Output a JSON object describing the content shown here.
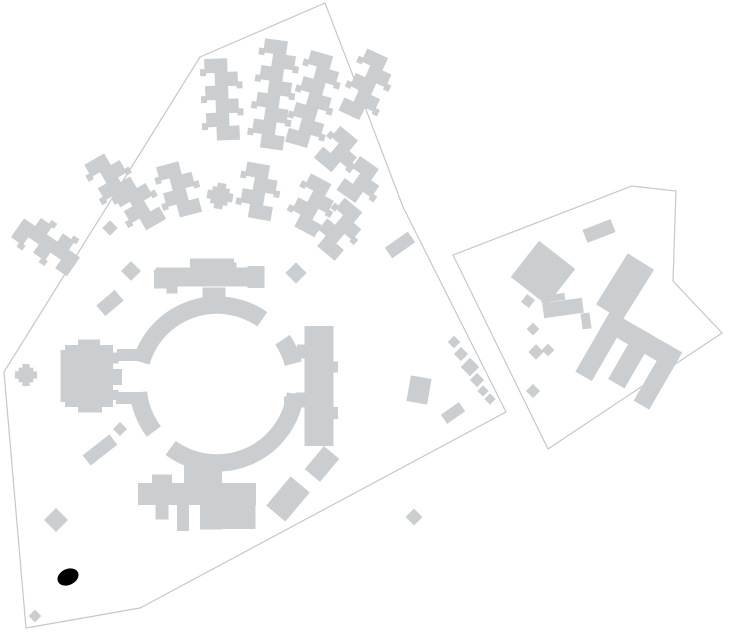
{
  "canvas": {
    "width": 734,
    "height": 639,
    "background": "#ffffff"
  },
  "palette": {
    "building_fill": "#cbced1",
    "boundary_stroke": "#c7c7c7",
    "marker_fill": "#000000"
  },
  "parcels": [
    {
      "name": "parcel-west-campus",
      "points": [
        [
          4,
          372
        ],
        [
          200,
          57
        ],
        [
          325,
          3
        ],
        [
          370,
          120
        ],
        [
          403,
          207
        ],
        [
          506,
          412
        ],
        [
          155,
          600
        ],
        [
          140,
          608
        ],
        [
          26,
          628
        ]
      ]
    },
    {
      "name": "parcel-east-campus",
      "points": [
        [
          453,
          255
        ],
        [
          632,
          186
        ],
        [
          676,
          191
        ],
        [
          673,
          281
        ],
        [
          722,
          333
        ],
        [
          548,
          449
        ]
      ]
    }
  ],
  "ring_building": {
    "name": "circular-ring-building",
    "cx": 217,
    "cy": 384,
    "radius_mid": 79,
    "band_width": 17.5,
    "segments_deg": [
      [
        7,
        126
      ],
      [
        143,
        174
      ],
      [
        196,
        305
      ],
      [
        326,
        345
      ]
    ]
  },
  "zigzag_blocks": {
    "brick_w": 23,
    "brick_h": 13.5,
    "offset": 5,
    "items": [
      {
        "name": "zigzag-far-west",
        "cx": 48,
        "cy": 243,
        "rot": -55,
        "bricks": 5
      },
      {
        "name": "zigzag-west-1",
        "cx": 112,
        "cy": 180,
        "rot": -30,
        "bricks": 4
      },
      {
        "name": "zigzag-west-2",
        "cx": 138,
        "cy": 203,
        "rot": -30,
        "bricks": 4
      },
      {
        "name": "zigzag-north-1",
        "cx": 222,
        "cy": 99,
        "rot": -2,
        "bricks": 6
      },
      {
        "name": "zigzag-north-2",
        "cx": 274,
        "cy": 94,
        "rot": 8,
        "bricks": 8
      },
      {
        "name": "zigzag-north-3",
        "cx": 314,
        "cy": 100,
        "rot": 16,
        "bricks": 7
      },
      {
        "name": "zigzag-northeast-1",
        "cx": 340,
        "cy": 152,
        "rot": 40,
        "bricks": 3
      },
      {
        "name": "zigzag-northeast-2",
        "cx": 368,
        "cy": 86,
        "rot": 25,
        "bricks": 5
      },
      {
        "name": "zigzag-east-1",
        "cx": 362,
        "cy": 182,
        "rot": 35,
        "bricks": 3
      },
      {
        "name": "zigzag-east-2",
        "cx": 340,
        "cy": 229,
        "rot": 40,
        "bricks": 4
      },
      {
        "name": "zigzag-inner-west",
        "cx": 179,
        "cy": 189,
        "rot": -15,
        "bricks": 4
      },
      {
        "name": "zigzag-inner-mid",
        "cx": 259,
        "cy": 191,
        "rot": 10,
        "bricks": 4
      },
      {
        "name": "zigzag-inner-east",
        "cx": 313,
        "cy": 205,
        "rot": 28,
        "bricks": 4
      }
    ]
  },
  "rect_blocks": [
    {
      "name": "west-hall-main",
      "cx": 89,
      "cy": 376,
      "w": 48,
      "h": 62,
      "rot": 0
    },
    {
      "name": "west-hall-wing",
      "cx": 64,
      "cy": 376,
      "w": 7,
      "h": 52,
      "rot": 0
    },
    {
      "name": "west-hall-tab-top",
      "cx": 89,
      "cy": 344,
      "w": 22,
      "h": 9,
      "rot": 0
    },
    {
      "name": "west-hall-tab-bottom",
      "cx": 90,
      "cy": 408,
      "w": 24,
      "h": 9,
      "rot": 0
    },
    {
      "name": "west-hall-bump-1",
      "cx": 114,
      "cy": 358,
      "w": 9,
      "h": 11,
      "rot": 0
    },
    {
      "name": "west-hall-bump-2",
      "cx": 116,
      "cy": 377,
      "w": 12,
      "h": 16,
      "rot": 0
    },
    {
      "name": "west-hall-bump-3",
      "cx": 114,
      "cy": 395,
      "w": 9,
      "h": 10,
      "rot": 0
    },
    {
      "name": "west-hall-link-top",
      "cx": 130,
      "cy": 355,
      "w": 26,
      "h": 12,
      "rot": 0
    },
    {
      "name": "west-hall-link-bottom",
      "cx": 128,
      "cy": 398,
      "w": 24,
      "h": 12,
      "rot": 0
    },
    {
      "name": "north-bar-main",
      "cx": 210,
      "cy": 277,
      "w": 108,
      "h": 19,
      "rot": 0
    },
    {
      "name": "north-bar-center",
      "cx": 212,
      "cy": 264,
      "w": 44,
      "h": 11,
      "rot": 0
    },
    {
      "name": "north-bar-cap-west",
      "cx": 162,
      "cy": 279,
      "w": 16,
      "h": 19,
      "rot": 0
    },
    {
      "name": "north-bar-cap-east",
      "cx": 256,
      "cy": 277,
      "w": 17,
      "h": 22,
      "rot": 0
    },
    {
      "name": "north-bar-tab-east",
      "cx": 231,
      "cy": 266,
      "w": 11,
      "h": 7,
      "rot": 0
    },
    {
      "name": "north-bar-nub-west",
      "cx": 172,
      "cy": 290,
      "w": 11,
      "h": 7,
      "rot": 0
    },
    {
      "name": "north-bar-stub",
      "cx": 214,
      "cy": 294,
      "w": 23,
      "h": 13,
      "rot": 0
    },
    {
      "name": "north-bar-stub-2",
      "cx": 215,
      "cy": 302,
      "w": 13,
      "h": 8,
      "rot": 0
    },
    {
      "name": "east-tower-main",
      "cx": 319,
      "cy": 386,
      "w": 29,
      "h": 120,
      "rot": 0
    },
    {
      "name": "east-tower-bump-1",
      "cx": 301,
      "cy": 351,
      "w": 8,
      "h": 13,
      "rot": 0
    },
    {
      "name": "east-tower-bump-2",
      "cx": 300,
      "cy": 400,
      "w": 9,
      "h": 15,
      "rot": 0
    },
    {
      "name": "east-tower-bump-3",
      "cx": 335,
      "cy": 367,
      "w": 6,
      "h": 11,
      "rot": 0
    },
    {
      "name": "east-tower-bump-4",
      "cx": 335,
      "cy": 413,
      "w": 6,
      "h": 12,
      "rot": 0
    },
    {
      "name": "east-tower-stub-1",
      "cx": 297,
      "cy": 353,
      "w": 20,
      "h": 11,
      "rot": 0
    },
    {
      "name": "east-tower-stub-2",
      "cx": 295,
      "cy": 402,
      "w": 22,
      "h": 11,
      "rot": 0
    },
    {
      "name": "south-wing-connector",
      "cx": 203,
      "cy": 474,
      "w": 38,
      "h": 22,
      "rot": 0
    },
    {
      "name": "south-wing-tab",
      "cx": 162,
      "cy": 479,
      "w": 20,
      "h": 9,
      "rot": 0
    },
    {
      "name": "south-wing-slab",
      "cx": 197,
      "cy": 494,
      "w": 118,
      "h": 22,
      "rot": 0
    },
    {
      "name": "south-wing-prong-1",
      "cx": 162,
      "cy": 512,
      "w": 13,
      "h": 15,
      "rot": 0
    },
    {
      "name": "south-wing-prong-2",
      "cx": 183,
      "cy": 518,
      "w": 12,
      "h": 26,
      "rot": 0
    },
    {
      "name": "south-wing-mid",
      "cx": 211,
      "cy": 517,
      "w": 22,
      "h": 25,
      "rot": 0
    },
    {
      "name": "south-wing-right",
      "cx": 237,
      "cy": 516,
      "w": 37,
      "h": 26,
      "rot": 0
    },
    {
      "name": "southwest-bar",
      "cx": 100,
      "cy": 450,
      "w": 34,
      "h": 13,
      "rot": -38
    },
    {
      "name": "northwest-bar",
      "cx": 110,
      "cy": 303,
      "w": 24,
      "h": 14,
      "rot": -40
    },
    {
      "name": "lone-east-bar",
      "cx": 400,
      "cy": 245,
      "w": 28,
      "h": 13,
      "rot": -35
    },
    {
      "name": "edge-rect",
      "cx": 419,
      "cy": 390,
      "w": 21,
      "h": 26,
      "rot": 10
    },
    {
      "name": "edge-bar",
      "cx": 453,
      "cy": 413,
      "w": 22,
      "h": 11,
      "rot": -35
    },
    {
      "name": "southeast-rect-1",
      "cx": 322,
      "cy": 464,
      "w": 20,
      "h": 30,
      "rot": 40
    },
    {
      "name": "southeast-rect-2",
      "cx": 288,
      "cy": 499,
      "w": 25,
      "h": 38,
      "rot": 40
    },
    {
      "name": "east-parcel-top-bar",
      "cx": 599,
      "cy": 231,
      "w": 30,
      "h": 14,
      "rot": -21
    },
    {
      "name": "east-parcel-square",
      "cx": 543,
      "cy": 273,
      "w": 46,
      "h": 46,
      "rot": 38
    },
    {
      "name": "east-parcel-tall",
      "cx": 625,
      "cy": 287,
      "w": 31,
      "h": 60,
      "rot": 32
    },
    {
      "name": "east-parcel-bar",
      "cx": 563,
      "cy": 308,
      "w": 40,
      "h": 15,
      "rot": -8
    },
    {
      "name": "east-parcel-ledge",
      "cx": 553,
      "cy": 298,
      "w": 24,
      "h": 7,
      "rot": -8
    },
    {
      "name": "east-parcel-nub",
      "cx": 586,
      "cy": 321,
      "w": 9,
      "h": 16,
      "rot": -8
    },
    {
      "name": "east-parcel-smallsq",
      "cx": 528,
      "cy": 301,
      "w": 10,
      "h": 10,
      "rot": 38
    }
  ],
  "diamond_blocks": [
    {
      "name": "diamond-1",
      "cx": 131,
      "cy": 271,
      "s": 14
    },
    {
      "name": "diamond-2",
      "cx": 296,
      "cy": 273,
      "s": 15
    },
    {
      "name": "diamond-3",
      "cx": 110,
      "cy": 228,
      "s": 11
    },
    {
      "name": "diamond-4",
      "cx": 56,
      "cy": 520,
      "s": 17
    },
    {
      "name": "diamond-5",
      "cx": 35,
      "cy": 616,
      "s": 9
    },
    {
      "name": "diamond-6",
      "cx": 414,
      "cy": 517,
      "s": 12
    },
    {
      "name": "diamond-7",
      "cx": 120,
      "cy": 429,
      "s": 10
    },
    {
      "name": "diamond-chain-1",
      "cx": 454,
      "cy": 342,
      "s": 9
    },
    {
      "name": "diamond-chain-2",
      "cx": 461,
      "cy": 354,
      "s": 10
    },
    {
      "name": "diamond-chain-3",
      "cx": 470,
      "cy": 367,
      "s": 13
    },
    {
      "name": "diamond-chain-4",
      "cx": 477,
      "cy": 380,
      "s": 10
    },
    {
      "name": "diamond-chain-5",
      "cx": 483,
      "cy": 391,
      "s": 8
    },
    {
      "name": "diamond-chain-6",
      "cx": 490,
      "cy": 399,
      "s": 8
    },
    {
      "name": "diamond-east-1",
      "cx": 533,
      "cy": 329,
      "s": 9
    },
    {
      "name": "diamond-east-2",
      "cx": 536,
      "cy": 352,
      "s": 11
    },
    {
      "name": "diamond-east-3",
      "cx": 548,
      "cy": 350,
      "s": 9
    },
    {
      "name": "diamond-east-4",
      "cx": 533,
      "cy": 391,
      "s": 10
    }
  ],
  "plus_blocks": [
    {
      "name": "plus-pavilion-west",
      "cx": 26,
      "cy": 375,
      "s": 22,
      "rot": 0
    },
    {
      "name": "plus-pavilion-inner",
      "cx": 220,
      "cy": 196,
      "s": 26,
      "rot": 10
    }
  ],
  "e_block": {
    "name": "east-parcel-e-building",
    "cx": 630,
    "cy": 357,
    "rot": 30,
    "spine": [
      -40,
      -30,
      83,
      20
    ],
    "teeth": [
      [
        -40,
        -30,
        19,
        70
      ],
      [
        -8,
        -30,
        19,
        60
      ],
      [
        25,
        -30,
        18,
        66
      ]
    ]
  },
  "marker": {
    "name": "location-marker",
    "cx": 68,
    "cy": 577,
    "rx": 11,
    "ry": 8,
    "rot": -25
  }
}
